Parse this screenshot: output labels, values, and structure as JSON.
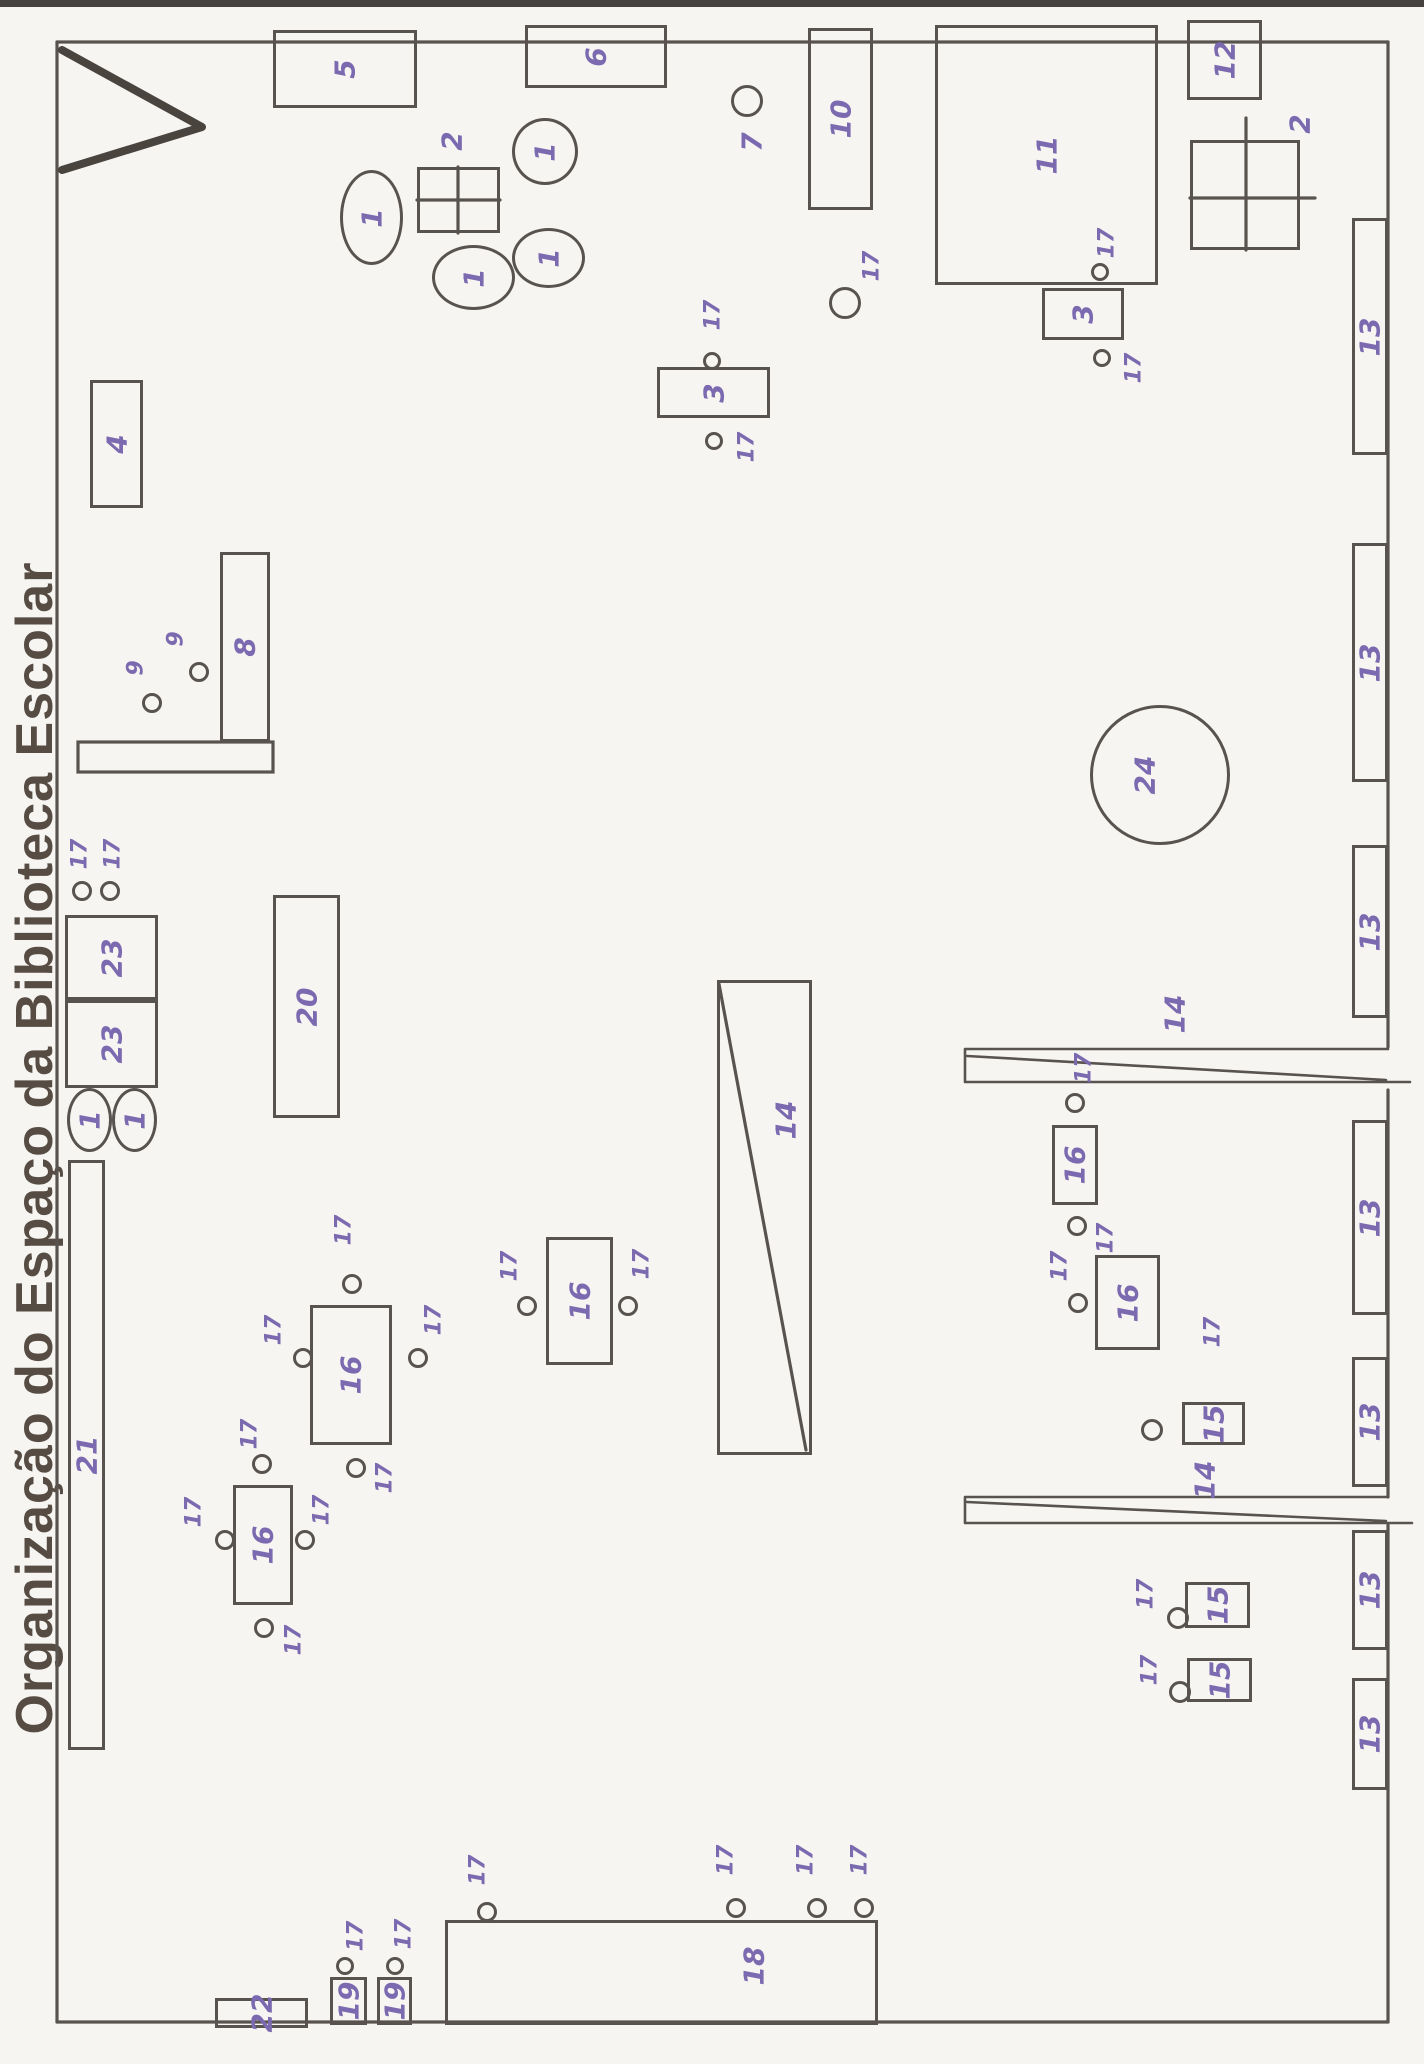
{
  "title": "Organização do Espaço da Biblioteca Escolar",
  "colors": {
    "paper": "#f6f5f1",
    "ink": "#59534f",
    "hand": "#7c6ab0",
    "title": "#564c44"
  },
  "plan": {
    "items": [
      {
        "n": "shelf-5",
        "s": "rect",
        "l": "5",
        "x": 273,
        "y": 30,
        "w": 144,
        "h": 78
      },
      {
        "n": "shelf-6",
        "s": "rect",
        "l": "6",
        "x": 525,
        "y": 25,
        "w": 142,
        "h": 63
      },
      {
        "n": "table-2",
        "s": "rect",
        "l": "2",
        "x": 417,
        "y": 167,
        "w": 83,
        "h": 66,
        "lx": 452,
        "ly": 141
      },
      {
        "n": "pouf-1",
        "s": "oval",
        "l": "1",
        "x": 340,
        "y": 170,
        "w": 63,
        "h": 95
      },
      {
        "n": "pouf-1",
        "s": "oval",
        "l": "1",
        "x": 512,
        "y": 118,
        "w": 66,
        "h": 67
      },
      {
        "n": "pouf-1",
        "s": "oval",
        "l": "1",
        "x": 432,
        "y": 245,
        "w": 83,
        "h": 65
      },
      {
        "n": "pouf-1",
        "s": "oval",
        "l": "1",
        "x": 512,
        "y": 228,
        "w": 73,
        "h": 60
      },
      {
        "n": "spot-7",
        "s": "circle",
        "l": "7",
        "x": 731,
        "y": 85,
        "w": 32,
        "h": 32,
        "lx": 752,
        "ly": 142
      },
      {
        "n": "shelf-10",
        "s": "rect",
        "l": "10",
        "x": 808,
        "y": 28,
        "w": 65,
        "h": 182
      },
      {
        "n": "area-11",
        "s": "rect",
        "l": "11",
        "x": 935,
        "y": 25,
        "w": 223,
        "h": 260
      },
      {
        "n": "shelf-12",
        "s": "rect",
        "l": "12",
        "x": 1187,
        "y": 20,
        "w": 75,
        "h": 80
      },
      {
        "n": "table-2",
        "s": "rect",
        "l": "2",
        "x": 1190,
        "y": 140,
        "w": 110,
        "h": 110,
        "lx": 1300,
        "ly": 124
      },
      {
        "n": "table-3",
        "s": "rect",
        "l": "3",
        "x": 657,
        "y": 367,
        "w": 113,
        "h": 51
      },
      {
        "n": "chair-17",
        "s": "circle",
        "l": "17",
        "x": 703,
        "y": 352,
        "w": 18,
        "h": 18,
        "lx": 713,
        "ly": 315,
        "sm": 1
      },
      {
        "n": "chair-17",
        "s": "circle",
        "l": "17",
        "x": 705,
        "y": 432,
        "w": 18,
        "h": 18,
        "lx": 747,
        "ly": 447,
        "sm": 1
      },
      {
        "n": "table-3",
        "s": "rect",
        "l": "3",
        "x": 1042,
        "y": 288,
        "w": 82,
        "h": 52
      },
      {
        "n": "chair-17",
        "s": "circle",
        "l": "17",
        "x": 1091,
        "y": 263,
        "w": 18,
        "h": 18,
        "lx": 1107,
        "ly": 243,
        "sm": 1
      },
      {
        "n": "chair-17",
        "s": "circle",
        "l": "17",
        "x": 1093,
        "y": 349,
        "w": 18,
        "h": 18,
        "lx": 1134,
        "ly": 368,
        "sm": 1
      },
      {
        "n": "chair-17",
        "s": "circle",
        "l": "17",
        "x": 829,
        "y": 287,
        "w": 32,
        "h": 32,
        "lx": 872,
        "ly": 266,
        "sm": 1
      },
      {
        "n": "wall-shelf-13",
        "s": "rect",
        "l": "13",
        "x": 1352,
        "y": 218,
        "w": 36,
        "h": 237
      },
      {
        "n": "wall-shelf-13",
        "s": "rect",
        "l": "13",
        "x": 1352,
        "y": 543,
        "w": 36,
        "h": 239
      },
      {
        "n": "wall-shelf-13",
        "s": "rect",
        "l": "13",
        "x": 1352,
        "y": 845,
        "w": 36,
        "h": 173
      },
      {
        "n": "wall-shelf-13",
        "s": "rect",
        "l": "13",
        "x": 1352,
        "y": 1120,
        "w": 36,
        "h": 195
      },
      {
        "n": "wall-shelf-13",
        "s": "rect",
        "l": "13",
        "x": 1352,
        "y": 1357,
        "w": 36,
        "h": 130
      },
      {
        "n": "wall-shelf-13",
        "s": "rect",
        "l": "13",
        "x": 1352,
        "y": 1530,
        "w": 36,
        "h": 120
      },
      {
        "n": "wall-shelf-13",
        "s": "rect",
        "l": "13",
        "x": 1352,
        "y": 1678,
        "w": 36,
        "h": 112
      },
      {
        "n": "round-table-24",
        "s": "circle",
        "l": "24",
        "x": 1090,
        "y": 705,
        "w": 140,
        "h": 140,
        "lx": 1145,
        "ly": 775
      },
      {
        "n": "shelf-20",
        "s": "rect",
        "l": "20",
        "x": 273,
        "y": 895,
        "w": 67,
        "h": 223
      },
      {
        "n": "chair-17",
        "s": "circle",
        "l": "17",
        "x": 72,
        "y": 881,
        "w": 20,
        "h": 20,
        "lx": 80,
        "ly": 854,
        "sm": 1
      },
      {
        "n": "chair-17",
        "s": "circle",
        "l": "17",
        "x": 100,
        "y": 881,
        "w": 20,
        "h": 20,
        "lx": 113,
        "ly": 854,
        "sm": 1
      },
      {
        "n": "cabinet-23",
        "s": "rect",
        "l": "23",
        "x": 65,
        "y": 915,
        "w": 93,
        "h": 85
      },
      {
        "n": "cabinet-23",
        "s": "rect",
        "l": "23",
        "x": 65,
        "y": 1000,
        "w": 93,
        "h": 88
      },
      {
        "n": "pouf-1",
        "s": "oval",
        "l": "1",
        "x": 67,
        "y": 1088,
        "w": 45,
        "h": 64
      },
      {
        "n": "pouf-1",
        "s": "oval",
        "l": "1",
        "x": 112,
        "y": 1088,
        "w": 45,
        "h": 64
      },
      {
        "n": "shelf-21",
        "s": "rect",
        "l": "21",
        "x": 68,
        "y": 1160,
        "w": 37,
        "h": 590
      },
      {
        "n": "shelf-4",
        "s": "rect",
        "l": "4",
        "x": 90,
        "y": 380,
        "w": 53,
        "h": 128
      },
      {
        "n": "shelf-8",
        "s": "rect",
        "l": "8",
        "x": 220,
        "y": 552,
        "w": 50,
        "h": 190
      },
      {
        "n": "seat-9",
        "s": "circle",
        "l": "9",
        "x": 189,
        "y": 662,
        "w": 20,
        "h": 20,
        "lx": 176,
        "ly": 639,
        "sm": 1
      },
      {
        "n": "seat-9",
        "s": "circle",
        "l": "9",
        "x": 142,
        "y": 693,
        "w": 20,
        "h": 20,
        "lx": 136,
        "ly": 668,
        "sm": 1
      },
      {
        "n": "display-stand-14",
        "s": "rect",
        "l": "14",
        "x": 717,
        "y": 980,
        "w": 95,
        "h": 475,
        "lx": 786,
        "ly": 1120
      },
      {
        "n": "door-14-label",
        "s": "label",
        "l": "14",
        "lx": 1175,
        "ly": 1014
      },
      {
        "n": "door-14-label",
        "s": "label",
        "l": "14",
        "lx": 1205,
        "ly": 1480
      },
      {
        "n": "table-16",
        "s": "rect",
        "l": "16",
        "x": 310,
        "y": 1305,
        "w": 82,
        "h": 140
      },
      {
        "n": "chair-17",
        "s": "circle",
        "l": "17",
        "x": 342,
        "y": 1274,
        "w": 20,
        "h": 20,
        "lx": 344,
        "ly": 1230,
        "sm": 1
      },
      {
        "n": "chair-17",
        "s": "circle",
        "l": "17",
        "x": 293,
        "y": 1348,
        "w": 20,
        "h": 20,
        "lx": 274,
        "ly": 1330,
        "sm": 1
      },
      {
        "n": "chair-17",
        "s": "circle",
        "l": "17",
        "x": 408,
        "y": 1348,
        "w": 20,
        "h": 20,
        "lx": 434,
        "ly": 1320,
        "sm": 1
      },
      {
        "n": "chair-17",
        "s": "circle",
        "l": "17",
        "x": 346,
        "y": 1458,
        "w": 20,
        "h": 20,
        "lx": 385,
        "ly": 1478,
        "sm": 1
      },
      {
        "n": "table-16",
        "s": "rect",
        "l": "16",
        "x": 546,
        "y": 1237,
        "w": 67,
        "h": 128
      },
      {
        "n": "chair-17",
        "s": "circle",
        "l": "17",
        "x": 517,
        "y": 1296,
        "w": 20,
        "h": 20,
        "lx": 510,
        "ly": 1266,
        "sm": 1
      },
      {
        "n": "chair-17",
        "s": "circle",
        "l": "17",
        "x": 618,
        "y": 1296,
        "w": 20,
        "h": 20,
        "lx": 642,
        "ly": 1264,
        "sm": 1
      },
      {
        "n": "table-16",
        "s": "rect",
        "l": "16",
        "x": 233,
        "y": 1485,
        "w": 60,
        "h": 120
      },
      {
        "n": "chair-17",
        "s": "circle",
        "l": "17",
        "x": 252,
        "y": 1454,
        "w": 20,
        "h": 20,
        "lx": 250,
        "ly": 1434,
        "sm": 1
      },
      {
        "n": "chair-17",
        "s": "circle",
        "l": "17",
        "x": 215,
        "y": 1530,
        "w": 20,
        "h": 20,
        "lx": 194,
        "ly": 1512,
        "sm": 1
      },
      {
        "n": "chair-17",
        "s": "circle",
        "l": "17",
        "x": 295,
        "y": 1530,
        "w": 20,
        "h": 20,
        "lx": 322,
        "ly": 1510,
        "sm": 1
      },
      {
        "n": "chair-17",
        "s": "circle",
        "l": "17",
        "x": 254,
        "y": 1618,
        "w": 20,
        "h": 20,
        "lx": 294,
        "ly": 1640,
        "sm": 1
      },
      {
        "n": "table-16",
        "s": "rect",
        "l": "16",
        "x": 1052,
        "y": 1125,
        "w": 46,
        "h": 80
      },
      {
        "n": "chair-17",
        "s": "circle",
        "l": "17",
        "x": 1065,
        "y": 1093,
        "w": 20,
        "h": 20,
        "lx": 1084,
        "ly": 1068,
        "sm": 1
      },
      {
        "n": "chair-17",
        "s": "circle",
        "l": "17",
        "x": 1067,
        "y": 1216,
        "w": 20,
        "h": 20,
        "lx": 1106,
        "ly": 1238,
        "sm": 1
      },
      {
        "n": "table-16",
        "s": "rect",
        "l": "16",
        "x": 1095,
        "y": 1255,
        "w": 65,
        "h": 95
      },
      {
        "n": "chair-17",
        "s": "circle",
        "l": "17",
        "x": 1068,
        "y": 1293,
        "w": 20,
        "h": 20,
        "lx": 1060,
        "ly": 1266,
        "sm": 1
      },
      {
        "n": "chair-17-label",
        "s": "label",
        "l": "17",
        "lx": 1213,
        "ly": 1332,
        "sm": 1
      },
      {
        "n": "table-15",
        "s": "rect",
        "l": "15",
        "x": 1182,
        "y": 1402,
        "w": 63,
        "h": 43
      },
      {
        "n": "chair",
        "s": "circle",
        "l": null,
        "x": 1141,
        "y": 1419,
        "w": 22,
        "h": 22
      },
      {
        "n": "table-15",
        "s": "rect",
        "l": "15",
        "x": 1185,
        "y": 1582,
        "w": 65,
        "h": 46
      },
      {
        "n": "chair-17",
        "s": "circle",
        "l": "17",
        "x": 1167,
        "y": 1607,
        "w": 22,
        "h": 22,
        "lx": 1146,
        "ly": 1594,
        "sm": 1
      },
      {
        "n": "table-15",
        "s": "rect",
        "l": "15",
        "x": 1187,
        "y": 1658,
        "w": 65,
        "h": 44
      },
      {
        "n": "chair-17",
        "s": "circle",
        "l": "17",
        "x": 1169,
        "y": 1681,
        "w": 22,
        "h": 22,
        "lx": 1150,
        "ly": 1670,
        "sm": 1
      },
      {
        "n": "counter-18",
        "s": "rect",
        "l": "18",
        "x": 445,
        "y": 1920,
        "w": 433,
        "h": 105,
        "lx": 754,
        "ly": 1966
      },
      {
        "n": "chair-17",
        "s": "circle",
        "l": "17",
        "x": 477,
        "y": 1902,
        "w": 20,
        "h": 20,
        "lx": 478,
        "ly": 1870,
        "sm": 1
      },
      {
        "n": "chair-17",
        "s": "circle",
        "l": "17",
        "x": 726,
        "y": 1898,
        "w": 20,
        "h": 20,
        "lx": 726,
        "ly": 1860,
        "sm": 1
      },
      {
        "n": "chair-17",
        "s": "circle",
        "l": "17",
        "x": 807,
        "y": 1898,
        "w": 20,
        "h": 20,
        "lx": 806,
        "ly": 1860,
        "sm": 1
      },
      {
        "n": "chair-17",
        "s": "circle",
        "l": "17",
        "x": 854,
        "y": 1898,
        "w": 20,
        "h": 20,
        "lx": 860,
        "ly": 1860,
        "sm": 1
      },
      {
        "n": "table-19",
        "s": "rect",
        "l": "19",
        "x": 330,
        "y": 1977,
        "w": 37,
        "h": 48
      },
      {
        "n": "chair-17",
        "s": "circle",
        "l": "17",
        "x": 336,
        "y": 1957,
        "w": 18,
        "h": 18,
        "lx": 356,
        "ly": 1936,
        "sm": 1
      },
      {
        "n": "table-19",
        "s": "rect",
        "l": "19",
        "x": 377,
        "y": 1977,
        "w": 35,
        "h": 48
      },
      {
        "n": "chair-17",
        "s": "circle",
        "l": "17",
        "x": 386,
        "y": 1957,
        "w": 18,
        "h": 18,
        "lx": 404,
        "ly": 1934,
        "sm": 1
      },
      {
        "n": "shelf-22",
        "s": "rect",
        "l": "22",
        "x": 215,
        "y": 1998,
        "w": 93,
        "h": 30
      }
    ]
  }
}
